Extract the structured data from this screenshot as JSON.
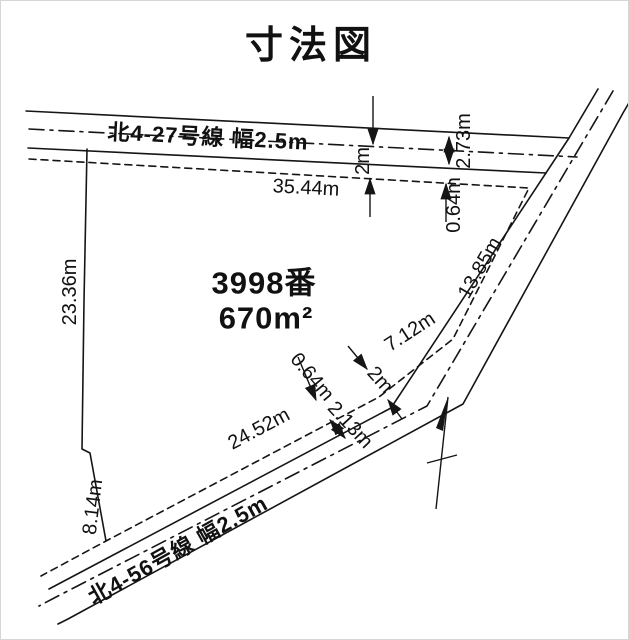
{
  "title": "寸法図",
  "parcel": {
    "number": "3998番",
    "area": "670m²"
  },
  "roads": {
    "north": {
      "label": "北4-27号線 幅2.5m"
    },
    "south": {
      "label": "北4-56号線 幅2.5m"
    }
  },
  "dimensions": {
    "north_boundary": "35.44m",
    "north_road_half": "2m",
    "north_road_width": "2.73m",
    "north_offset": "0.64m",
    "west_boundary": "23.36m",
    "east_boundary_upper": "13.85m",
    "east_boundary_mid": "7.12m",
    "south_offset": "0.64m",
    "south_road_half": "2m",
    "south_road_width": "2.13m",
    "south_boundary": "24.52m",
    "southwest_boundary": "8.14m"
  },
  "icons": {
    "north_arrow": "north-arrow"
  },
  "colors": {
    "line": "#151515",
    "background": "#ffffff"
  }
}
